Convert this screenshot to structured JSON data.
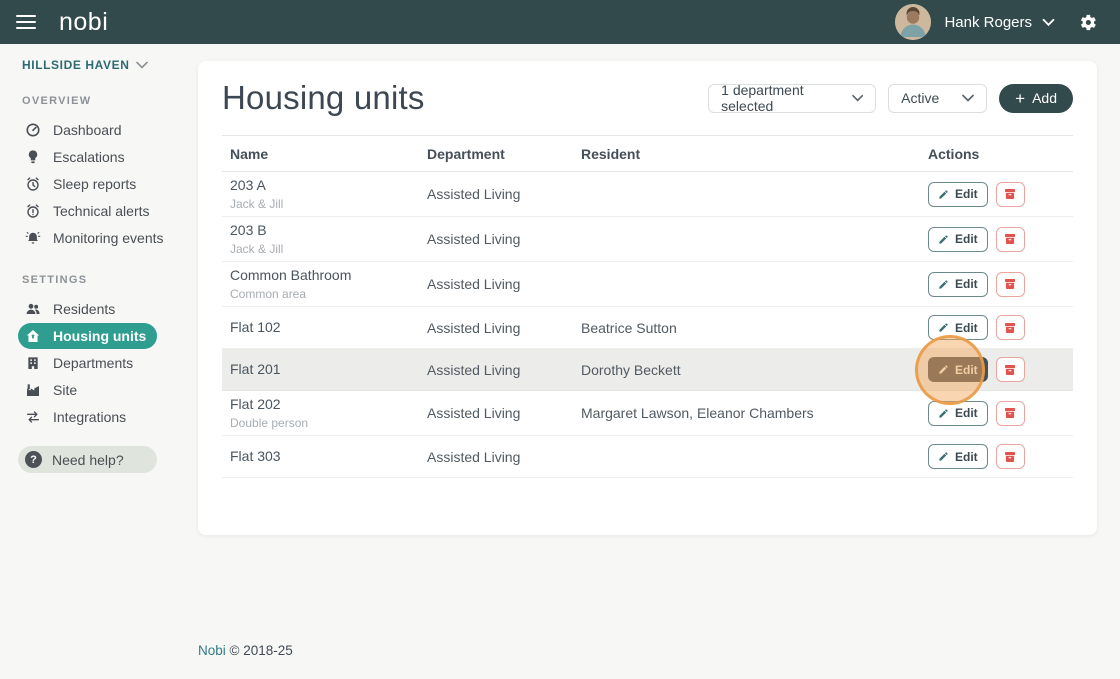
{
  "topbar": {
    "logo": "nobi",
    "user_name": "Hank Rogers"
  },
  "sidebar": {
    "facility": "HILLSIDE HAVEN",
    "sections": [
      {
        "label": "OVERVIEW",
        "items": [
          {
            "icon": "gauge-icon",
            "label": "Dashboard"
          },
          {
            "icon": "lightbulb-icon",
            "label": "Escalations"
          },
          {
            "icon": "alarm-clock-icon",
            "label": "Sleep reports"
          },
          {
            "icon": "alarm-alert-icon",
            "label": "Technical alerts"
          },
          {
            "icon": "bell-icon",
            "label": "Monitoring events"
          }
        ]
      },
      {
        "label": "SETTINGS",
        "items": [
          {
            "icon": "people-icon",
            "label": "Residents"
          },
          {
            "icon": "house-icon",
            "label": "Housing units",
            "active": true
          },
          {
            "icon": "building-icon",
            "label": "Departments"
          },
          {
            "icon": "factory-icon",
            "label": "Site"
          },
          {
            "icon": "swap-arrows-icon",
            "label": "Integrations"
          }
        ]
      }
    ],
    "help": {
      "icon_glyph": "?",
      "label": "Need help?"
    }
  },
  "main": {
    "title": "Housing units",
    "filters": {
      "department_selected": "1 department selected",
      "status_selected": "Active",
      "add_label": "Add",
      "add_plus": "+"
    },
    "table": {
      "headers": [
        "Name",
        "Department",
        "Resident",
        "Actions"
      ],
      "edit_label": "Edit",
      "rows": [
        {
          "name": "203 A",
          "sub": "Jack & Jill",
          "department": "Assisted Living",
          "resident": ""
        },
        {
          "name": "203 B",
          "sub": "Jack & Jill",
          "department": "Assisted Living",
          "resident": ""
        },
        {
          "name": "Common Bathroom",
          "sub": "Common area",
          "department": "Assisted Living",
          "resident": ""
        },
        {
          "name": "Flat 102",
          "sub": "",
          "department": "Assisted Living",
          "resident": "Beatrice Sutton"
        },
        {
          "name": "Flat 201",
          "sub": "",
          "department": "Assisted Living",
          "resident": "Dorothy Beckett",
          "highlighted": true
        },
        {
          "name": "Flat 202",
          "sub": "Double person",
          "department": "Assisted Living",
          "resident": "Margaret Lawson, Eleanor Chambers"
        },
        {
          "name": "Flat 303",
          "sub": "",
          "department": "Assisted Living",
          "resident": ""
        }
      ]
    }
  },
  "footer": {
    "brand": "Nobi",
    "copyright": "© 2018-25"
  },
  "colors": {
    "topbar_bg": "#324a4c",
    "active_pill": "#2f9e90",
    "page_bg": "#f7f7f5",
    "row_highlight": "#ececea",
    "edit_teal": "#3a7072",
    "danger_red": "#e0544d",
    "click_highlight_orange": "#f0a35c",
    "footer_link_teal": "#2e7d85",
    "facility_teal": "#2c6b72"
  }
}
